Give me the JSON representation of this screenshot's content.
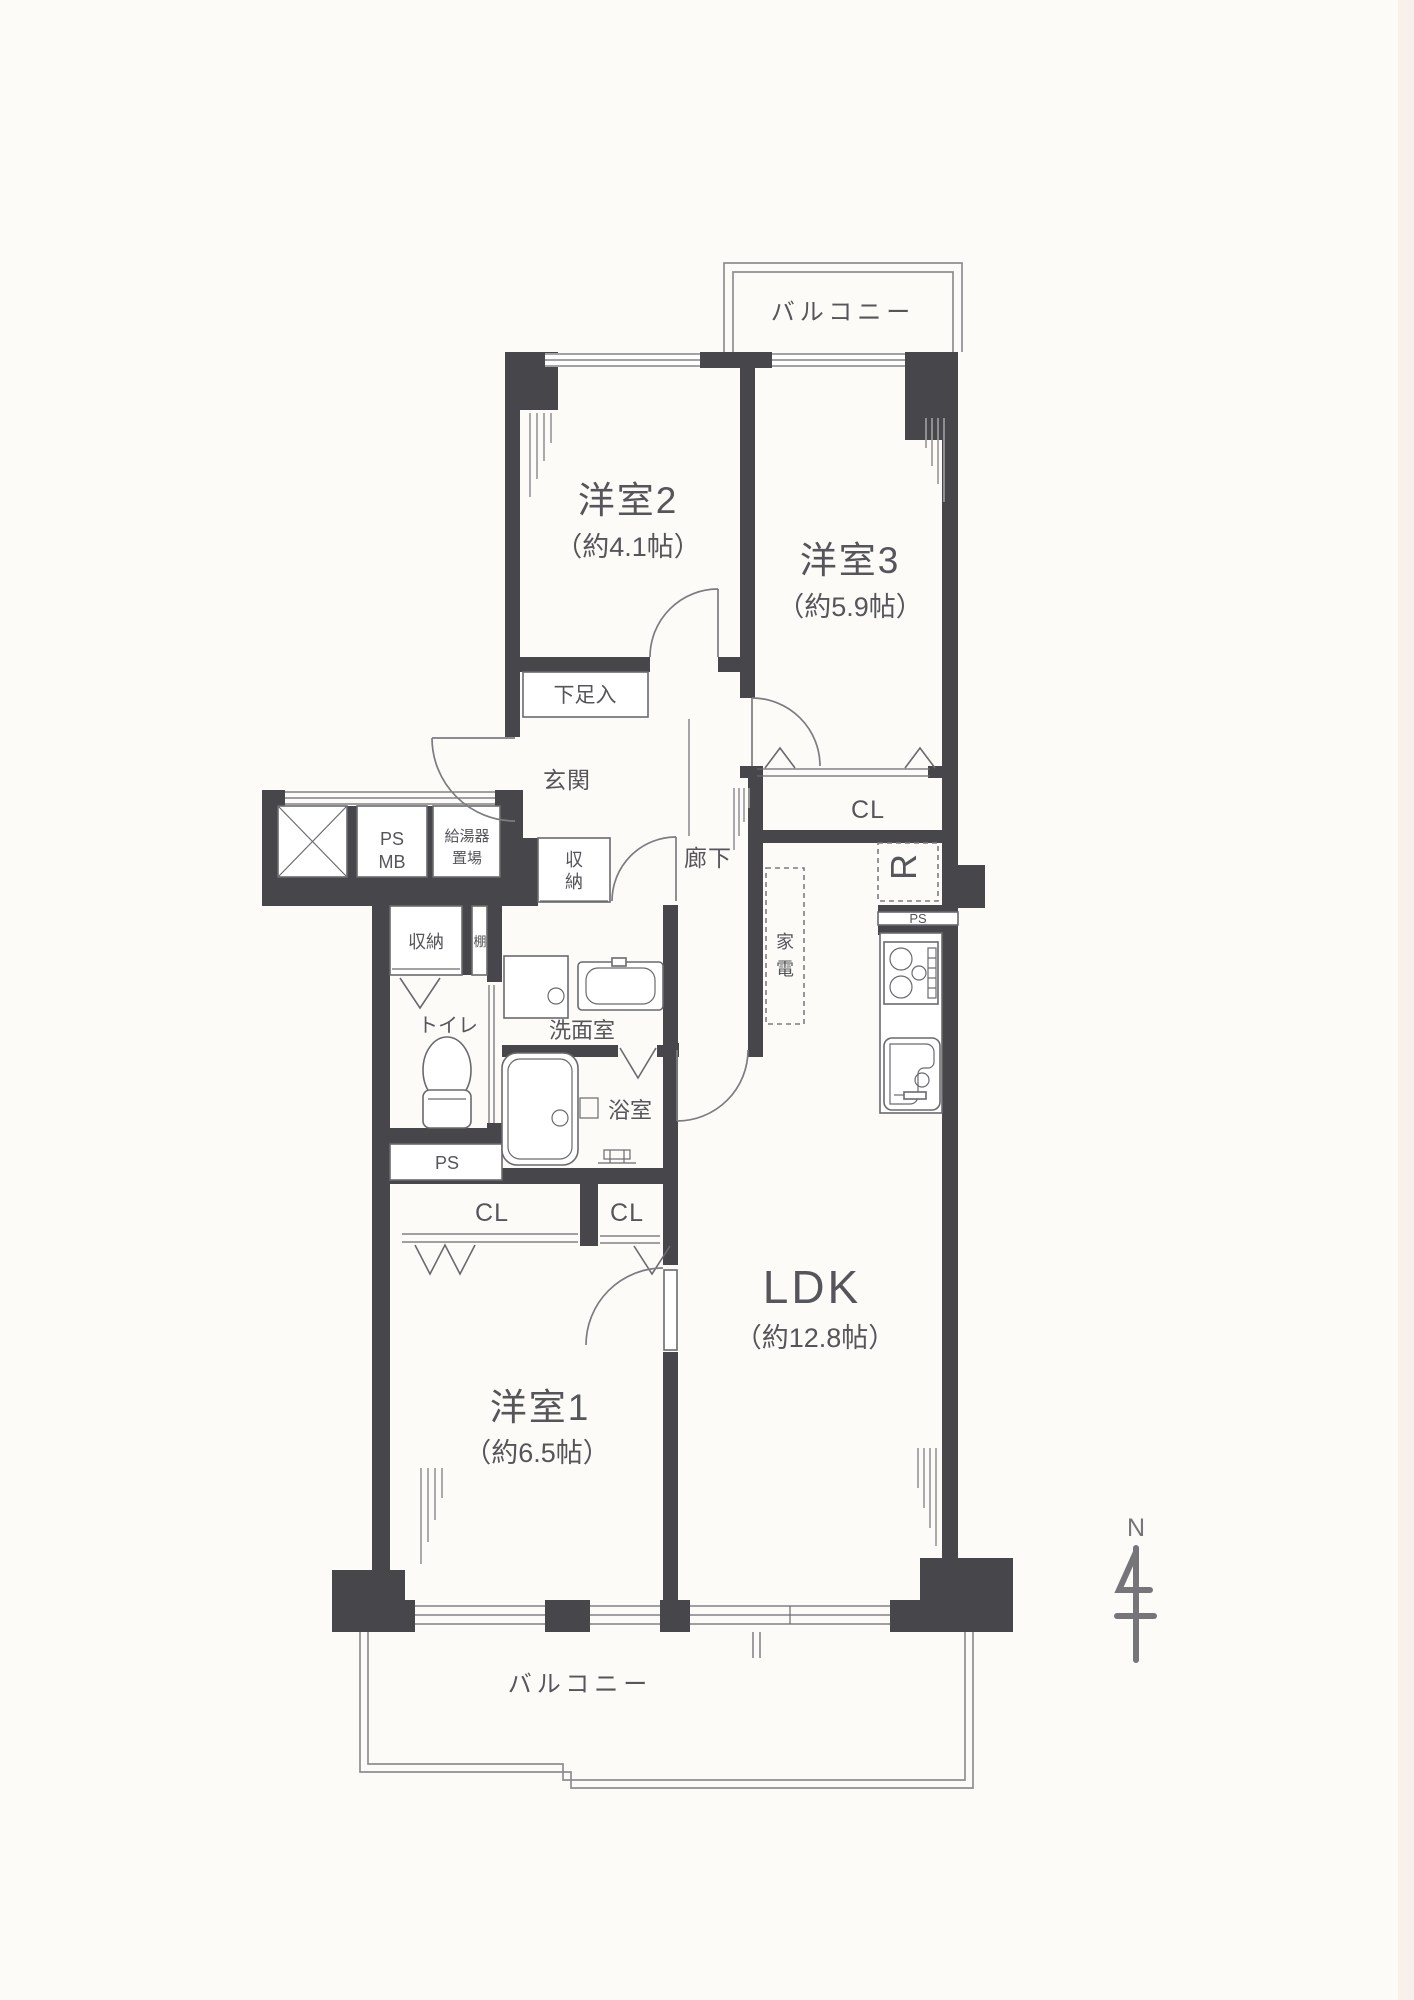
{
  "labels": {
    "balcony_top": "バルコニー",
    "balcony_bottom": "バルコニー",
    "western2": {
      "name": "洋室2",
      "size": "（約4.1帖）"
    },
    "western3": {
      "name": "洋室3",
      "size": "（約5.9帖）"
    },
    "western1": {
      "name": "洋室1",
      "size": "（約6.5帖）"
    },
    "ldk": {
      "name": "LDK",
      "size": "（約12.8帖）"
    },
    "shoe_box": "下足入",
    "entrance": "玄関",
    "hallway": "廊下",
    "ps": "PS",
    "mb": "MB",
    "water_heater": [
      "給湯器",
      "置場"
    ],
    "storage_hall": [
      "収",
      "納"
    ],
    "storage_wc": "収納",
    "shelf": "棚",
    "washroom": "洗面室",
    "toilet": "トイレ",
    "bath": "浴室",
    "ps_lower": "PS",
    "ps_kitchen": "PS",
    "closet_w3": "CL",
    "closet_left": "CL",
    "closet_right": "CL",
    "fridge": "R",
    "appliances": [
      "家",
      "電"
    ],
    "compass_north": "N"
  },
  "colors": {
    "wall": "#47474b",
    "line": "#6a6a6e",
    "text": "#55555a"
  }
}
